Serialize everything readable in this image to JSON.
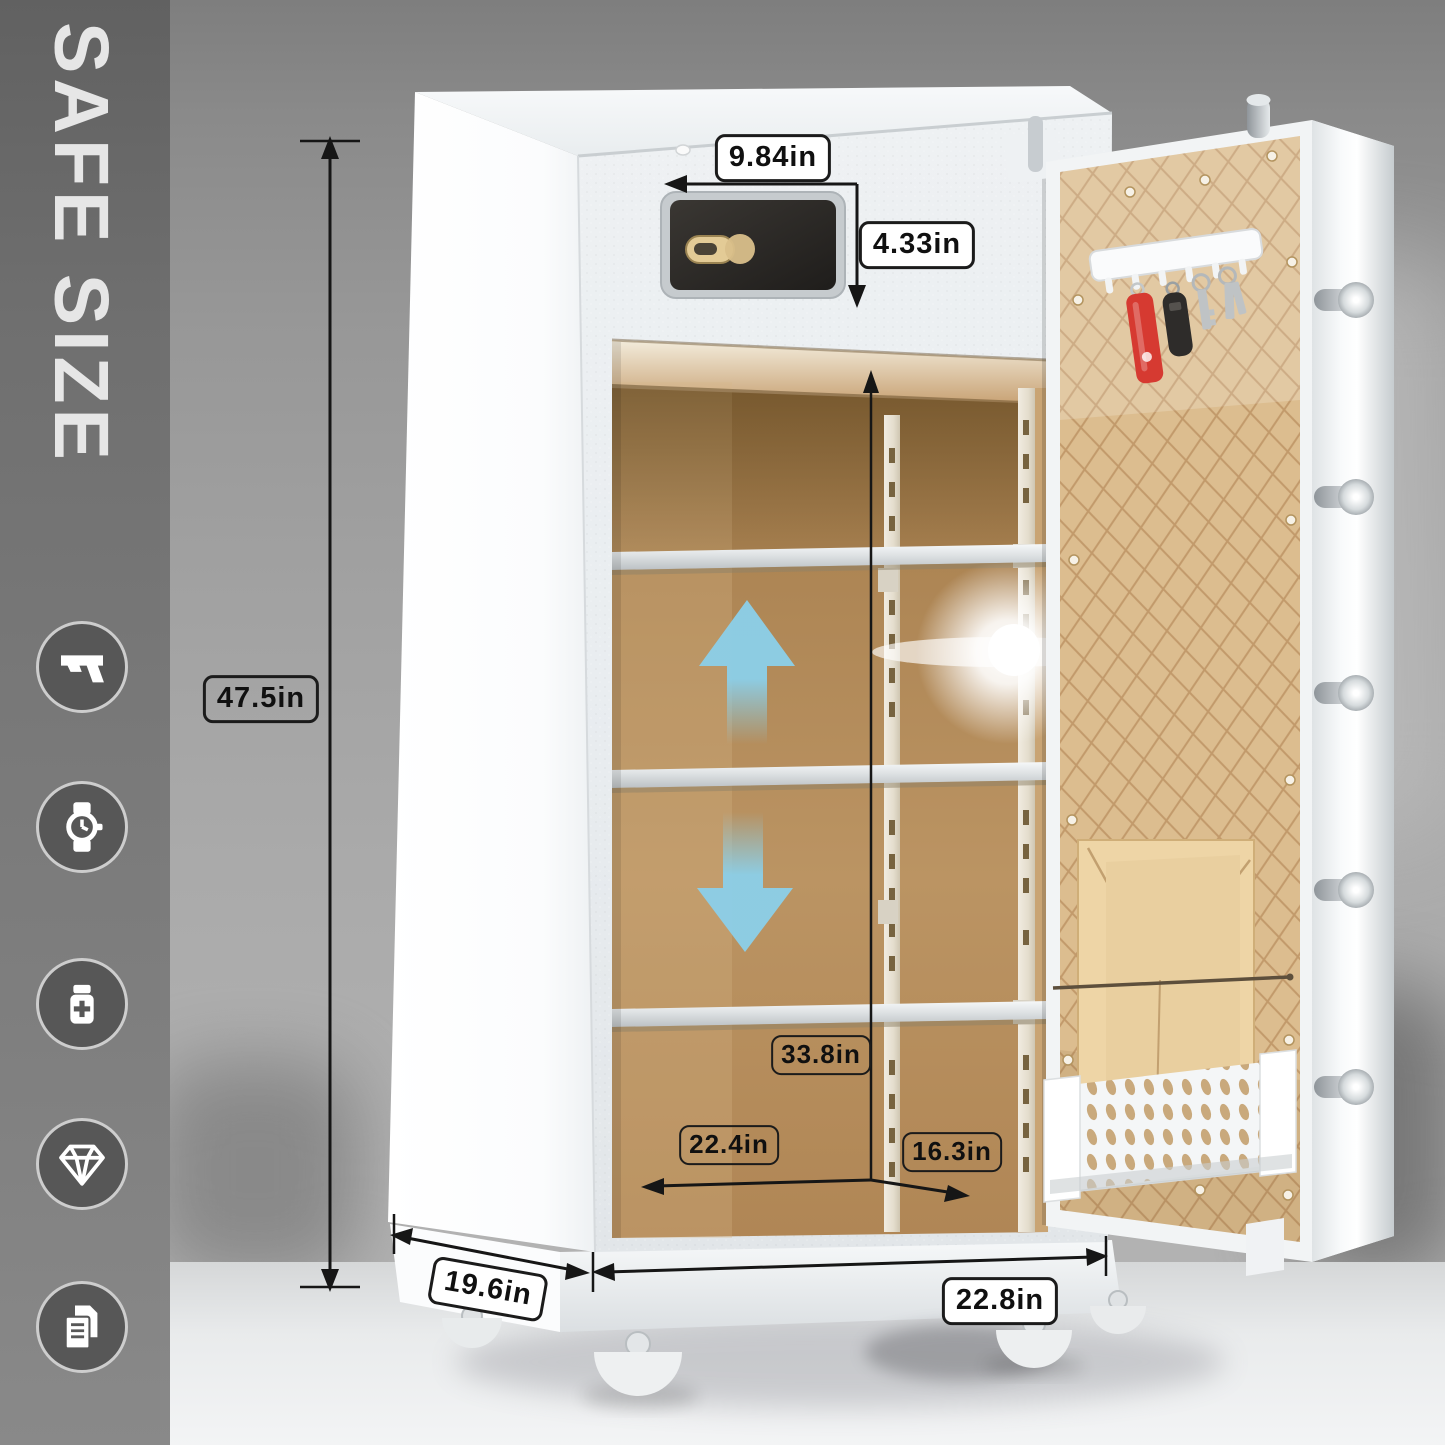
{
  "page": {
    "type": "safe product dimension diagram"
  },
  "sidebar": {
    "title": "SAFE SIZE",
    "icons": [
      {
        "name": "pistol-icon",
        "label": "handgun"
      },
      {
        "name": "watch-icon",
        "label": "wristwatch"
      },
      {
        "name": "medicine-icon",
        "label": "medicine bottle"
      },
      {
        "name": "diamond-icon",
        "label": "jewelry"
      },
      {
        "name": "documents-icon",
        "label": "documents"
      }
    ]
  },
  "dimensions": {
    "height": "47.5in",
    "keypad_width": "9.84in",
    "keypad_height": "4.33in",
    "interior_height": "33.8in",
    "interior_width": "22.4in",
    "interior_depth": "16.3in",
    "depth": "19.6in",
    "width": "22.8in"
  },
  "colors": {
    "sidebar_gray": "#6f6f6f",
    "safe_white": "#eff2f4",
    "interior_tan": "#b28854",
    "door_quilt_tan": "#dcbd8f",
    "arrow_blue": "#8bcfe9",
    "label_border": "#1b1b1b"
  }
}
